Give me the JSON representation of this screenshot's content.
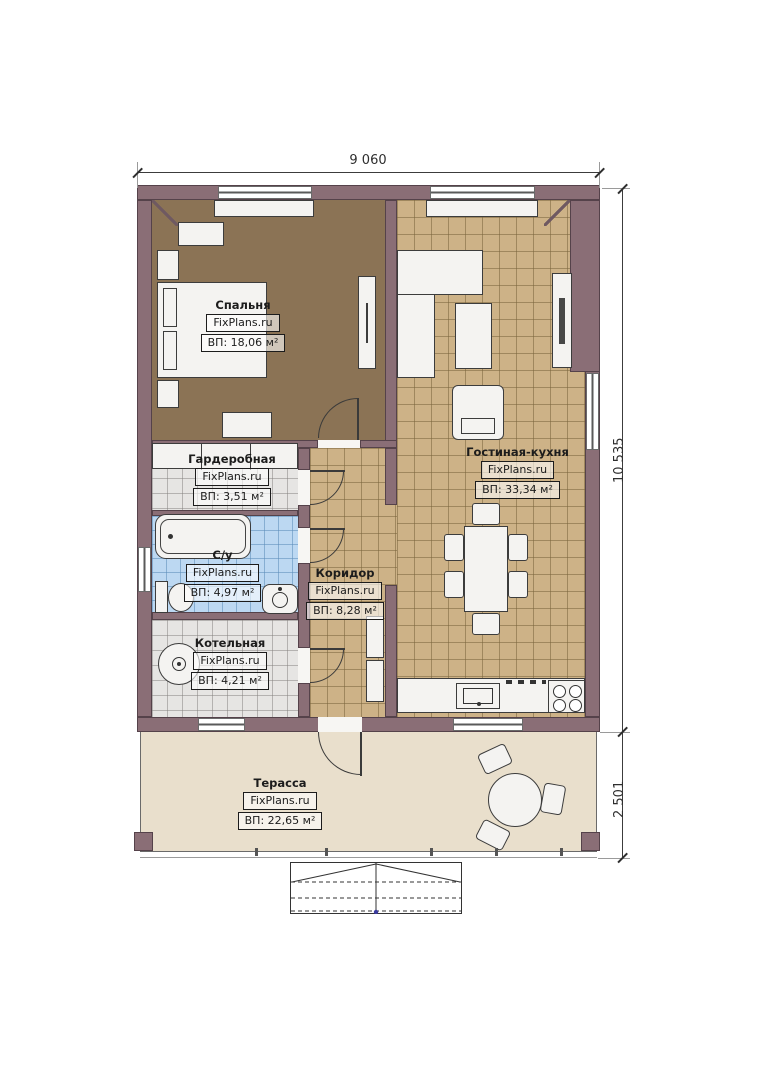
{
  "watermark": "FixPlans.ru",
  "dimensions": {
    "top": "9 060",
    "main_height": "10 535",
    "terrace_height": "2 501"
  },
  "rooms": [
    {
      "id": "bedroom",
      "name": "Спальня",
      "brand": "FixPlans.ru",
      "area": "ВП: 18,06 м²"
    },
    {
      "id": "wardrobe",
      "name": "Гардеробная",
      "brand": "FixPlans.ru",
      "area": "ВП: 3,51 м²"
    },
    {
      "id": "bathroom",
      "name": "С/у",
      "brand": "FixPlans.ru",
      "area": "ВП: 4,97 м²"
    },
    {
      "id": "boiler-room",
      "name": "Котельная",
      "brand": "FixPlans.ru",
      "area": "ВП: 4,21 м²"
    },
    {
      "id": "corridor",
      "name": "Коридор",
      "brand": "FixPlans.ru",
      "area": "ВП: 8,28 м²"
    },
    {
      "id": "living-kitchen",
      "name": "Гостиная-кухня",
      "brand": "FixPlans.ru",
      "area": "ВП: 33,34 м²"
    },
    {
      "id": "terrace",
      "name": "Терасса",
      "brand": "FixPlans.ru",
      "area": "ВП: 22,65 м²"
    }
  ],
  "colors": {
    "wall": "#8a6e76",
    "bedroom_floor": "#8b7355",
    "tile_tan": "#cdb287",
    "tile_gray": "#e6e5e3",
    "tile_blue": "#bcd8f2",
    "terrace_floor": "#e9dfcc",
    "furniture": "#f4f3f1"
  }
}
